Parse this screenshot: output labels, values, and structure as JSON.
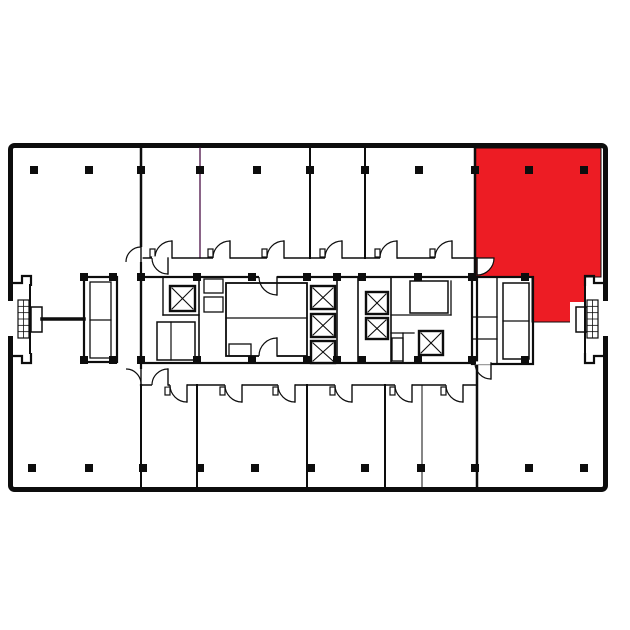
{
  "scene": {
    "width": 630,
    "height": 630,
    "background": "#ffffff"
  },
  "palette": {
    "wall": "#0d0d0d",
    "accent_wall": "#4b1046",
    "highlight": "#ed1c24",
    "floor": "#ffffff"
  },
  "floor_plan": {
    "outer_wall": {
      "x": 8,
      "y": 143,
      "width": 600,
      "height": 349,
      "thickness": 5,
      "corner_radius": 4
    },
    "wall_openings": [
      [
        6,
        301,
        8,
        35
      ],
      [
        602,
        301,
        8,
        35
      ]
    ],
    "highlight_suite": {
      "points": [
        [
          475,
          148
        ],
        [
          601,
          148
        ],
        [
          601,
          277
        ],
        [
          585,
          277
        ],
        [
          585,
          322
        ],
        [
          532,
          322
        ],
        [
          532,
          277
        ],
        [
          475,
          277
        ]
      ],
      "knockouts": [
        [
          570,
          302,
          16,
          21
        ]
      ]
    },
    "walls": [
      [
        141,
        148,
        141,
        258,
        2.5,
        "wall"
      ],
      [
        200,
        148,
        200,
        258,
        1.3,
        "accent"
      ],
      [
        310,
        148,
        310,
        258,
        2,
        "wall"
      ],
      [
        365,
        148,
        365,
        258,
        2,
        "wall"
      ],
      [
        475,
        148,
        475,
        277,
        2.5,
        "wall"
      ],
      [
        141,
        385,
        141,
        487,
        2,
        "wall"
      ],
      [
        197,
        385,
        197,
        487,
        2,
        "wall"
      ],
      [
        307,
        385,
        307,
        487,
        2,
        "wall"
      ],
      [
        385,
        385,
        385,
        487,
        2,
        "wall"
      ],
      [
        422,
        385,
        422,
        487,
        1,
        "wall"
      ],
      [
        477,
        363,
        477,
        487,
        2.5,
        "wall"
      ],
      [
        141,
        258,
        477,
        258,
        1.6,
        "wall"
      ],
      [
        141,
        385,
        477,
        385,
        1.6,
        "wall"
      ],
      [
        141,
        258,
        141,
        385,
        2.2,
        "wall"
      ],
      [
        163,
        277,
        163,
        315,
        1.4,
        "wall"
      ],
      [
        163,
        315,
        199,
        315,
        1.4,
        "wall"
      ],
      [
        199,
        277,
        199,
        363,
        1.6,
        "wall"
      ],
      [
        171,
        322,
        171,
        360,
        1.2,
        "wall"
      ],
      [
        226,
        318,
        307,
        318,
        1.3,
        "wall"
      ],
      [
        337,
        277,
        337,
        363,
        1.6,
        "wall"
      ],
      [
        358,
        277,
        358,
        363,
        1.6,
        "wall"
      ],
      [
        391,
        277,
        391,
        363,
        1.6,
        "wall"
      ],
      [
        391,
        315,
        451,
        315,
        1.3,
        "wall"
      ],
      [
        451,
        281,
        451,
        315,
        1.3,
        "wall"
      ],
      [
        391,
        333,
        414,
        333,
        1.3,
        "wall"
      ],
      [
        403,
        333,
        403,
        363,
        1.3,
        "wall"
      ],
      [
        497,
        277,
        497,
        363,
        1.4,
        "wall"
      ],
      [
        472,
        317,
        497,
        317,
        1.3,
        "wall"
      ],
      [
        472,
        339,
        497,
        339,
        1.3,
        "wall"
      ],
      [
        503,
        321,
        529,
        321,
        1.2,
        "wall"
      ],
      [
        90,
        320,
        111,
        320,
        1.2,
        "wall"
      ],
      [
        42,
        319,
        84,
        319,
        3.5,
        "wall"
      ],
      [
        30,
        285,
        30,
        353,
        2,
        "wall"
      ],
      [
        585,
        277,
        585,
        363,
        2,
        "wall"
      ]
    ],
    "rooms": [
      [
        157,
        322,
        38,
        38,
        1.5
      ],
      [
        204,
        279,
        19,
        14,
        1.3
      ],
      [
        204,
        297,
        19,
        15,
        1.3
      ],
      [
        226,
        283,
        81,
        73,
        1.8
      ],
      [
        229,
        344,
        22,
        12,
        1.3
      ],
      [
        410,
        281,
        38,
        32,
        1.5
      ],
      [
        392,
        338,
        11,
        23,
        1.3
      ],
      [
        141,
        277,
        336,
        86,
        2.2
      ],
      [
        84,
        277,
        33,
        85,
        2.2
      ],
      [
        90,
        282,
        21,
        76,
        1.3
      ],
      [
        472,
        277,
        61,
        87,
        2.2
      ],
      [
        503,
        283,
        26,
        76,
        1.5
      ],
      [
        31,
        307,
        11,
        25,
        1.5
      ],
      [
        576,
        307,
        11,
        25,
        1.5
      ]
    ],
    "elevators": [
      [
        170,
        286,
        25,
        25
      ],
      [
        311,
        286,
        24,
        23
      ],
      [
        311,
        314,
        24,
        23
      ],
      [
        311,
        341,
        24,
        22
      ],
      [
        366,
        292,
        22,
        22
      ],
      [
        366,
        318,
        22,
        21
      ],
      [
        419,
        331,
        24,
        24
      ]
    ],
    "doors": [
      {
        "gap": [
          155,
          256.4,
          17,
          3.2
        ],
        "arc": "M 172,241 A 17 17 0 0 0 155,258",
        "leaf": [
          172,
          241,
          172,
          258
        ],
        "latch": [
          150,
          249,
          5,
          8
        ]
      },
      {
        "gap": [
          213,
          256.4,
          17,
          3.2
        ],
        "arc": "M 230,241 A 17 17 0 0 0 213,258",
        "leaf": [
          230,
          241,
          230,
          258
        ],
        "latch": [
          208,
          249,
          5,
          8
        ]
      },
      {
        "gap": [
          267,
          256.4,
          17,
          3.2
        ],
        "arc": "M 284,241 A 17 17 0 0 0 267,258",
        "leaf": [
          284,
          241,
          284,
          258
        ],
        "latch": [
          262,
          249,
          5,
          8
        ]
      },
      {
        "gap": [
          325,
          256.4,
          17,
          3.2
        ],
        "arc": "M 342,241 A 17 17 0 0 0 325,258",
        "leaf": [
          342,
          241,
          342,
          258
        ],
        "latch": [
          320,
          249,
          5,
          8
        ]
      },
      {
        "gap": [
          380,
          256.4,
          17,
          3.2
        ],
        "arc": "M 397,241 A 17 17 0 0 0 380,258",
        "leaf": [
          397,
          241,
          397,
          258
        ],
        "latch": [
          375,
          249,
          5,
          8
        ]
      },
      {
        "gap": [
          435,
          256.4,
          17,
          3.2
        ],
        "arc": "M 452,241 A 17 17 0 0 0 435,258",
        "leaf": [
          452,
          241,
          452,
          258
        ],
        "latch": [
          430,
          249,
          5,
          8
        ]
      },
      {
        "gap": [
          170,
          383.4,
          17,
          3.2
        ],
        "arc": "M 187,402 A 17 17 0 0 1 170,385",
        "leaf": [
          187,
          385,
          187,
          402
        ],
        "latch": [
          165,
          387,
          5,
          8
        ]
      },
      {
        "gap": [
          225,
          383.4,
          17,
          3.2
        ],
        "arc": "M 242,402 A 17 17 0 0 1 225,385",
        "leaf": [
          242,
          385,
          242,
          402
        ],
        "latch": [
          220,
          387,
          5,
          8
        ]
      },
      {
        "gap": [
          278,
          383.4,
          17,
          3.2
        ],
        "arc": "M 295,402 A 17 17 0 0 1 278,385",
        "leaf": [
          295,
          385,
          295,
          402
        ],
        "latch": [
          273,
          387,
          5,
          8
        ]
      },
      {
        "gap": [
          335,
          383.4,
          17,
          3.2
        ],
        "arc": "M 352,402 A 17 17 0 0 1 335,385",
        "leaf": [
          352,
          385,
          352,
          402
        ],
        "latch": [
          330,
          387,
          5,
          8
        ]
      },
      {
        "gap": [
          395,
          383.4,
          17,
          3.2
        ],
        "arc": "M 412,402 A 17 17 0 0 1 395,385",
        "leaf": [
          412,
          385,
          412,
          402
        ],
        "latch": [
          390,
          387,
          5,
          8
        ]
      },
      {
        "gap": [
          446,
          383.4,
          17,
          3.2
        ],
        "arc": "M 463,402 A 17 17 0 0 1 446,385",
        "leaf": [
          463,
          385,
          463,
          402
        ],
        "latch": [
          441,
          387,
          5,
          8
        ]
      },
      {
        "gap": [
          139.4,
          247,
          3.2,
          15
        ],
        "arc": "M 141,247 A 15 15 0 0 0 126,262",
        "leaf": [
          141,
          247,
          141,
          262
        ]
      },
      {
        "gap": [
          139.4,
          369,
          3.2,
          15
        ],
        "arc": "M 126,369 A 15 15 0 0 1 141,384",
        "leaf": [
          141,
          369,
          141,
          384
        ]
      },
      {
        "gap": [
          152,
          256.4,
          16,
          3.2
        ],
        "arc": "M 152,258 A 16 16 0 0 0 168,274",
        "leaf": [
          168,
          258,
          168,
          274
        ]
      },
      {
        "gap": [
          152,
          383.4,
          16,
          3.2
        ],
        "arc": "M 152,385 A 16 16 0 0 1 168,369",
        "leaf": [
          168,
          385,
          168,
          369
        ]
      },
      {
        "gap": [
          259,
          275.4,
          18,
          3.2
        ],
        "arc": "M 259,277 A 18 18 0 0 0 277,295",
        "leaf": [
          277,
          277,
          277,
          295
        ]
      },
      {
        "gap": [
          259,
          354.4,
          18,
          3.2
        ],
        "arc": "M 259,356 A 18 18 0 0 1 277,338",
        "leaf": [
          277,
          356,
          277,
          338
        ]
      },
      {
        "gap": [
          475,
          361.4,
          16,
          3.2
        ],
        "arc": "M 475,363 A 16 16 0 0 0 491,379",
        "leaf": [
          491,
          363,
          491,
          379
        ]
      },
      {
        "filled": true,
        "arc": "M 494,258 A 17 17 0 0 1 477,275 L 477,258 Z",
        "leaf": [
          477,
          258,
          477,
          275
        ]
      }
    ],
    "columns": {
      "size": 8,
      "positions": [
        [
          30,
          166
        ],
        [
          85,
          166
        ],
        [
          137,
          166
        ],
        [
          196,
          166
        ],
        [
          253,
          166
        ],
        [
          306,
          166
        ],
        [
          361,
          166
        ],
        [
          415,
          166
        ],
        [
          471,
          166
        ],
        [
          525,
          166
        ],
        [
          580,
          166
        ],
        [
          28,
          464
        ],
        [
          85,
          464
        ],
        [
          139,
          464
        ],
        [
          196,
          464
        ],
        [
          251,
          464
        ],
        [
          307,
          464
        ],
        [
          361,
          464
        ],
        [
          417,
          464
        ],
        [
          471,
          464
        ],
        [
          525,
          464
        ],
        [
          580,
          464
        ]
      ]
    },
    "piers": {
      "size": 8,
      "positions": [
        [
          137,
          273
        ],
        [
          193,
          273
        ],
        [
          248,
          273
        ],
        [
          303,
          273
        ],
        [
          333,
          273
        ],
        [
          358,
          273
        ],
        [
          414,
          273
        ],
        [
          137,
          356
        ],
        [
          193,
          356
        ],
        [
          248,
          356
        ],
        [
          303,
          356
        ],
        [
          333,
          356
        ],
        [
          358,
          356
        ],
        [
          414,
          356
        ],
        [
          80,
          273
        ],
        [
          109,
          273
        ],
        [
          80,
          356
        ],
        [
          109,
          356
        ],
        [
          468,
          273
        ],
        [
          521,
          273
        ],
        [
          468,
          356
        ],
        [
          521,
          356
        ]
      ]
    },
    "ladders": [
      {
        "x": 18,
        "y": 300,
        "w": 11,
        "h": 38,
        "rows": 6,
        "cols": 2
      },
      {
        "x": 587,
        "y": 300,
        "w": 11,
        "h": 38,
        "rows": 6,
        "cols": 2
      }
    ],
    "brackets": [
      "M 13,283 H 22 V 276 H 31 V 286",
      "M 13,356 H 22 V 363 H 31 V 353",
      "M 603,283 H 594 V 276 H 585 V 286",
      "M 603,356 H 594 V 363 H 585 V 353"
    ]
  }
}
